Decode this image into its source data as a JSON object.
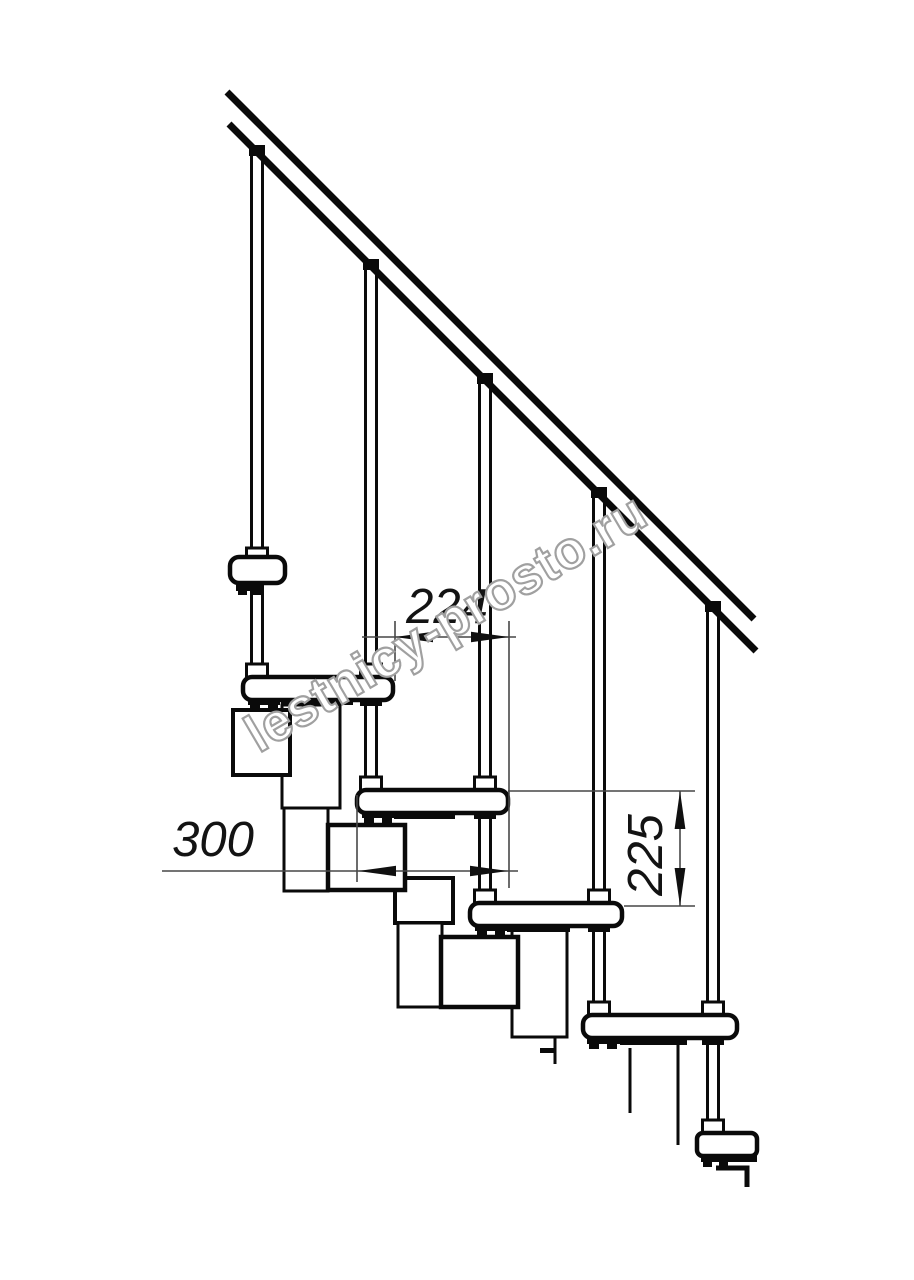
{
  "document": {
    "type": "technical-drawing",
    "subject": "Side elevation of a modular staircase with handrail and balusters",
    "background": "#ffffff",
    "ink_color": "#0a0a0a",
    "dimension_line_color": "#474747"
  },
  "dimensions": {
    "step_run": {
      "label": "224"
    },
    "tread_depth": {
      "label": "300"
    },
    "step_rise": {
      "label": "225"
    }
  },
  "watermark": {
    "text": "lestnicy-prosto.ru",
    "outline_color": "#a0a0a0"
  }
}
